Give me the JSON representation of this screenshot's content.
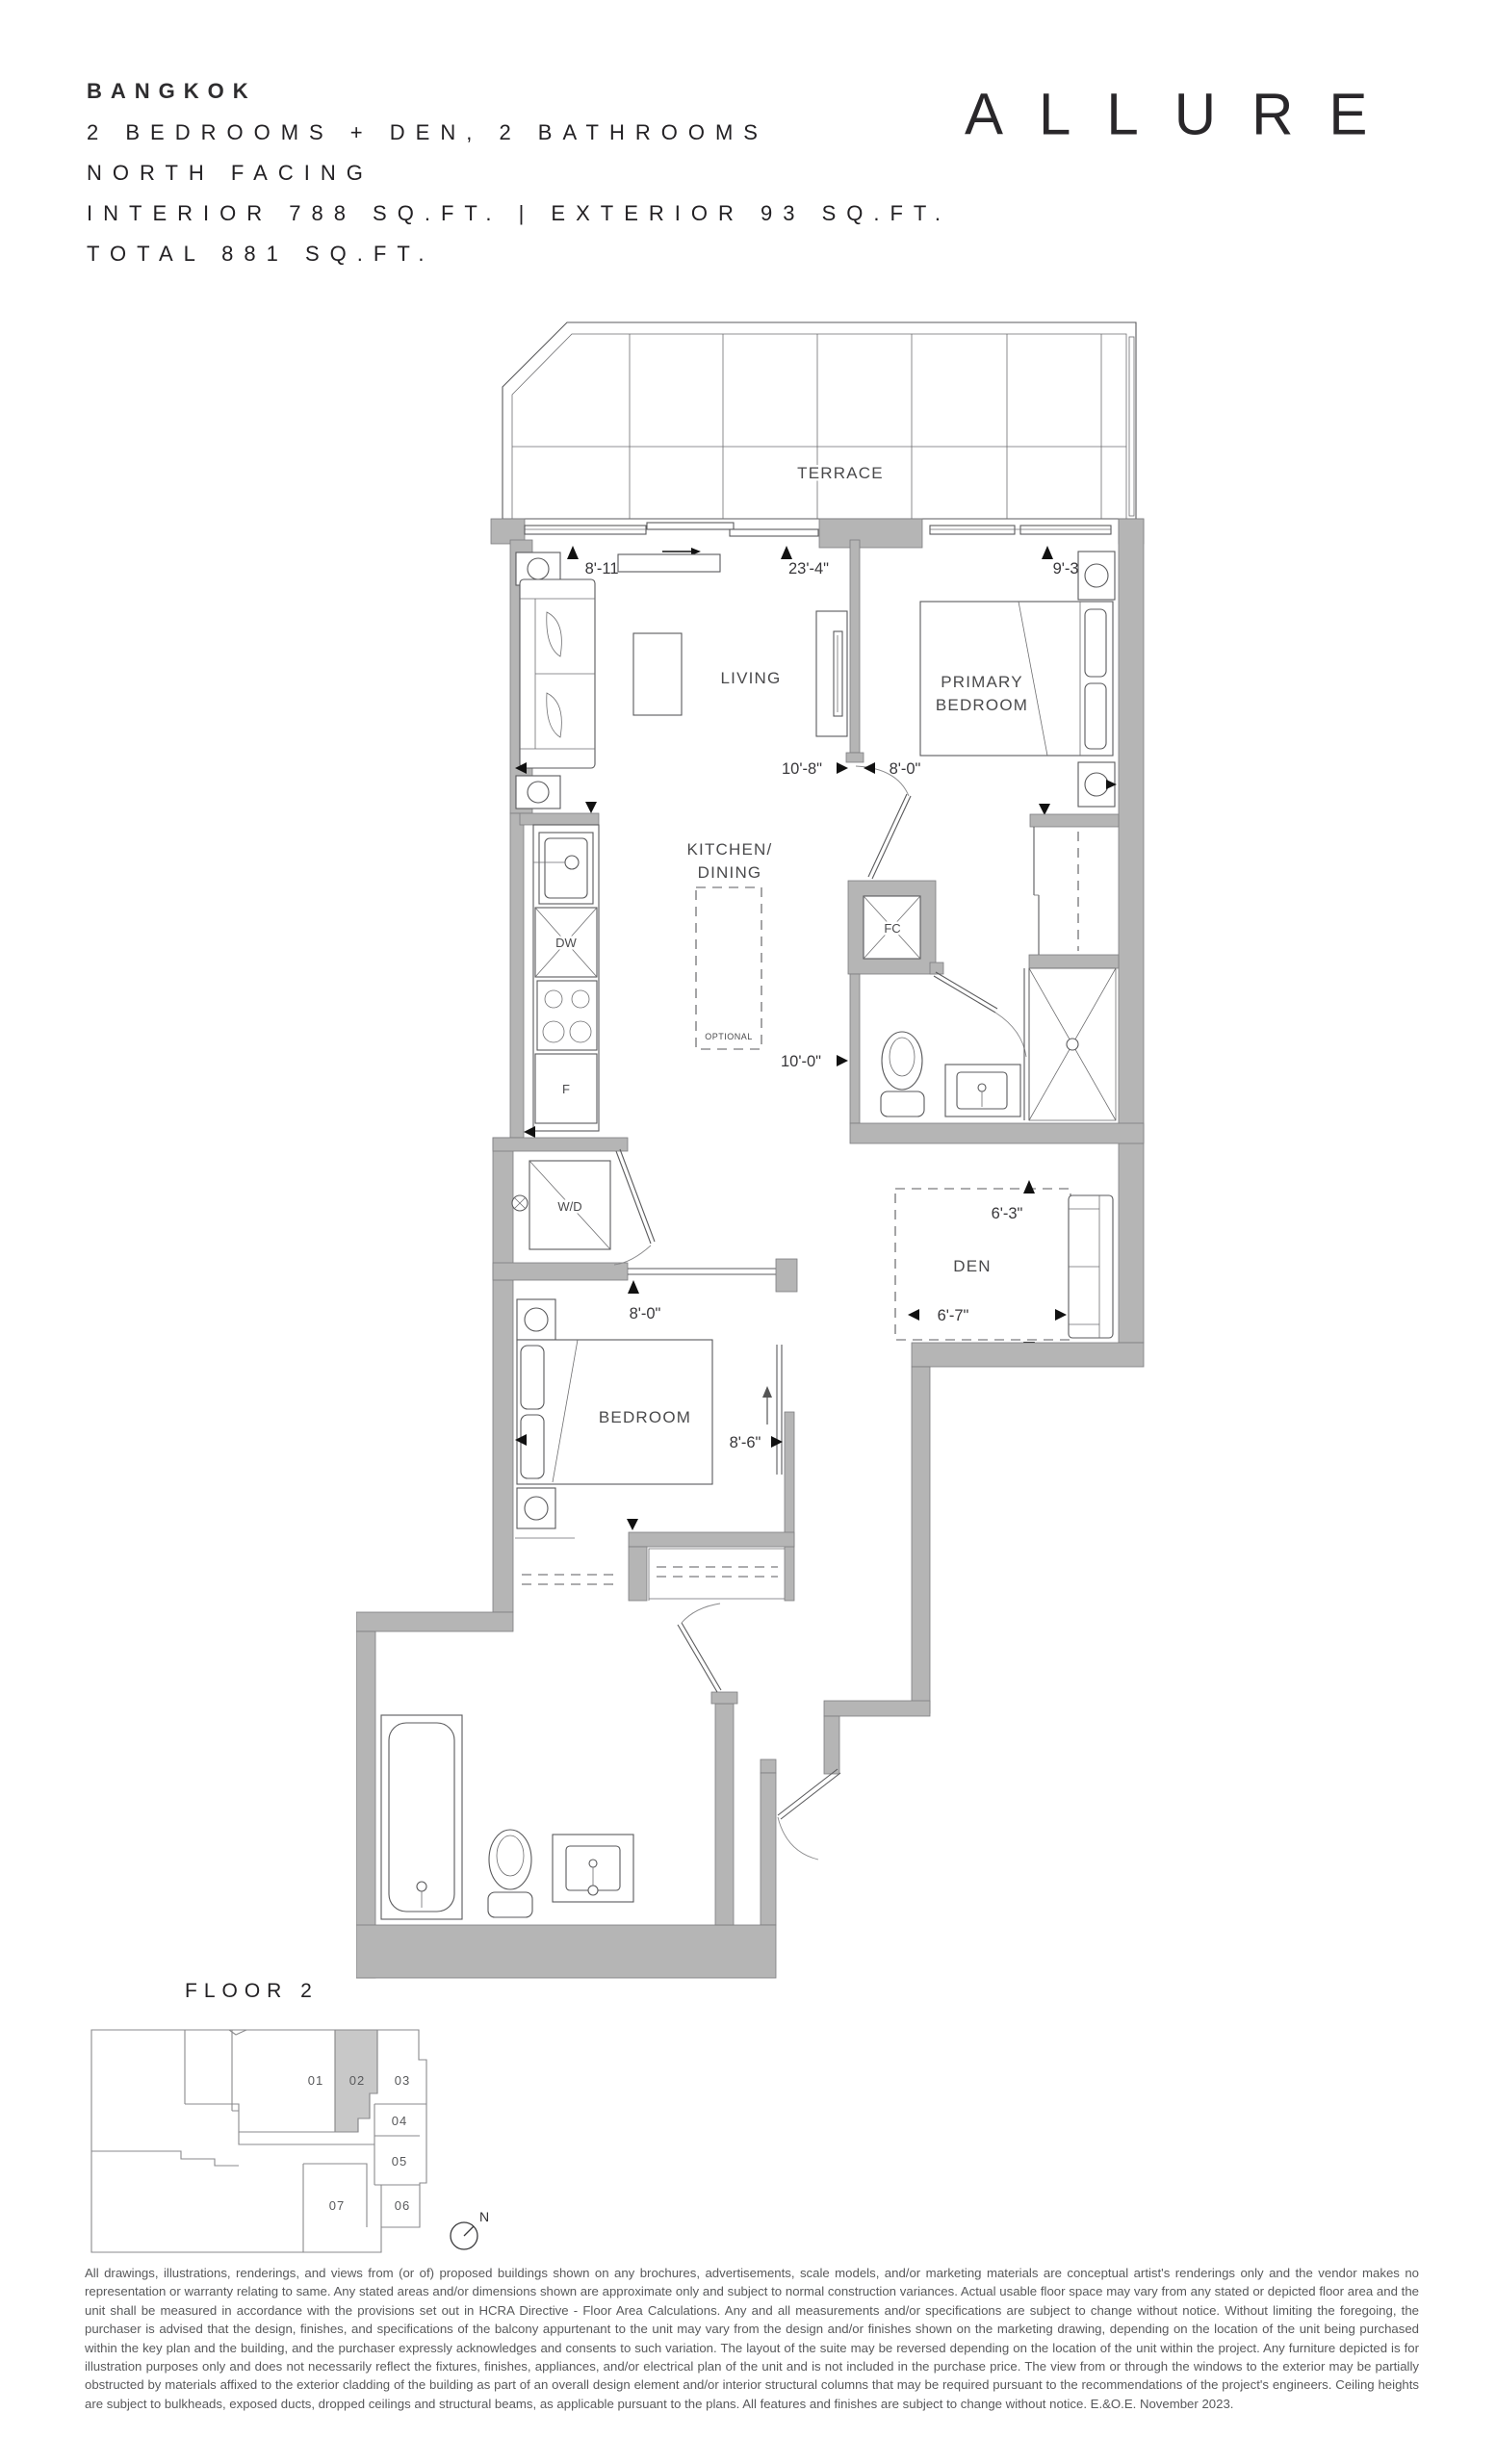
{
  "header": {
    "unit_name": "BANGKOK",
    "config_line": "2 BEDROOMS + DEN, 2 BATHROOMS",
    "facing_line": "NORTH FACING",
    "area_line": "INTERIOR 788 SQ.FT. | EXTERIOR 93 SQ.FT.",
    "total_line": "TOTAL 881 SQ.FT.",
    "brand": "ALLURE"
  },
  "plan": {
    "rooms": {
      "terrace": "TERRACE",
      "living": "LIVING",
      "primary_line1": "PRIMARY",
      "primary_line2": "BEDROOM",
      "kitchen_line1": "KITCHEN/",
      "kitchen_line2": "DINING",
      "bedroom": "BEDROOM",
      "den": "DEN"
    },
    "fixtures": {
      "dishwasher": "DW",
      "fridge": "F",
      "front_closet": "FC",
      "washer_dryer": "W/D",
      "island_note": "OPTIONAL"
    },
    "dimensions": {
      "living_left": "8'-11\"",
      "overall_width": "23'-4\"",
      "primary_width": "9'-3\"",
      "living_depth": "10'-8\"",
      "primary_depth": "8'-0\"",
      "bath_width": "10'-0\"",
      "bedroom_width": "8'-0\"",
      "bedroom_depth": "8'-6\"",
      "den_width": "6'-3\"",
      "den_depth": "6'-7\""
    }
  },
  "keyplan": {
    "title": "FLOOR 2",
    "units": [
      "01",
      "02",
      "03",
      "04",
      "05",
      "06",
      "07"
    ],
    "highlighted_unit": "02",
    "north_label": "N"
  },
  "footer": {
    "disclaimer": "All drawings, illustrations, renderings, and views from (or of) proposed buildings shown on any brochures, advertisements, scale models, and/or marketing materials are conceptual artist's renderings only and the vendor makes no representation or warranty relating to same. Any stated areas and/or dimensions shown are approximate only and subject to normal construction variances. Actual usable floor space may vary from any stated or depicted floor area and the unit shall be measured in accordance with the provisions set out in HCRA Directive - Floor Area Calculations. Any and all measurements and/or specifications are subject to change without notice. Without limiting the foregoing, the purchaser is advised that the design, finishes, and specifications of the balcony appurtenant to the unit may vary from the design and/or finishes shown on the marketing drawing, depending on the location of the unit being purchased within the key plan and the building, and the purchaser expressly acknowledges and consents to such variation. The layout of the suite may be reversed depending on the location of the unit within the project. Any furniture depicted is for illustration purposes only and does not necessarily reflect the fixtures, finishes, appliances, and/or electrical plan of the unit and is not included in the purchase price. The view from or through the windows to the exterior may be partially obstructed by materials affixed to the exterior cladding of the building as part of an overall design element and/or interior structural columns that may be required pursuant to the recommendations of the project's engineers. Ceiling heights are subject to bulkheads, exposed ducts, dropped ceilings and structural beams, as applicable pursuant to the plans. All features and finishes are subject to change without notice. E.&O.E. November 2023."
  },
  "colors": {
    "wall_gray": "#b5b5b5",
    "line": "#5a5a5c",
    "highlight_gray": "#c8c8c8",
    "text": "#2e2d2f",
    "disclaimer_text": "#58595b"
  }
}
